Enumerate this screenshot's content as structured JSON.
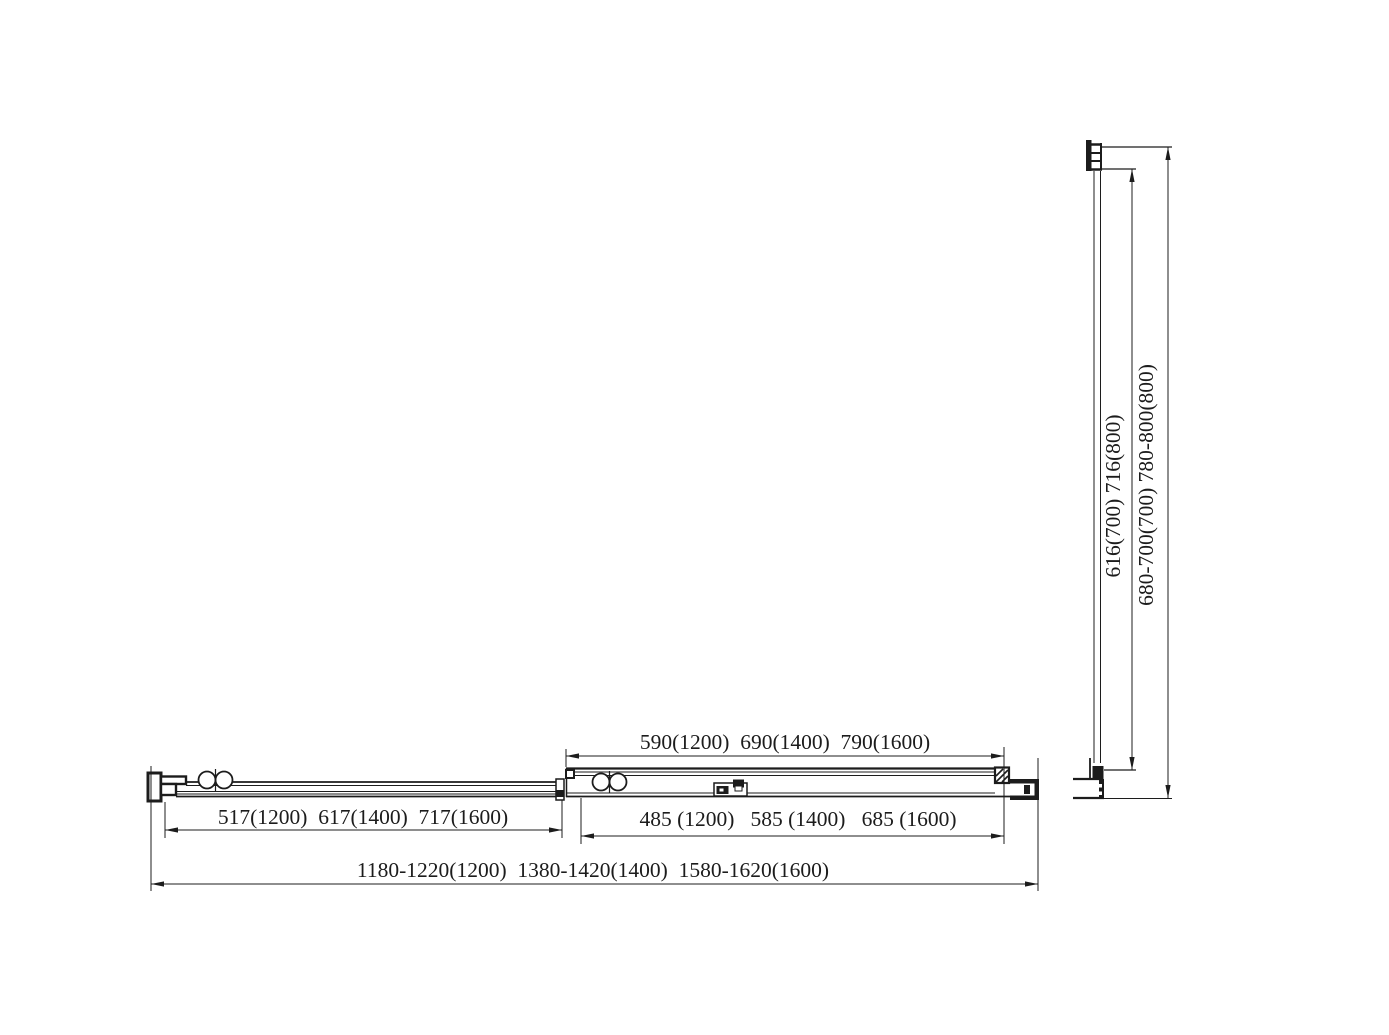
{
  "colors": {
    "background": "#ffffff",
    "ink": "#1c1c1c"
  },
  "diagram": {
    "plan_view": {
      "dim_door_opening": "590(1200)  690(1400)  790(1600)",
      "dim_sliding_panel": "517(1200)  617(1400)  717(1600)",
      "dim_fixed_panel": "485 (1200)   585 (1400)   685 (1600)",
      "dim_overall_width": "1180-1220(1200)  1380-1420(1400)  1580-1620(1600)"
    },
    "side_view": {
      "dim_glass_height": "616(700) 716(800)",
      "dim_overall_height": "680-700(700) 780-800(800)"
    }
  }
}
